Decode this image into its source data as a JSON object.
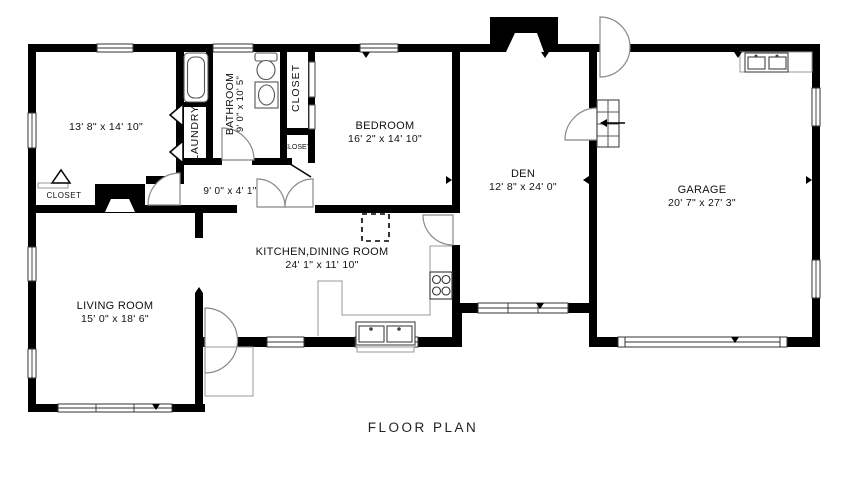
{
  "title": "FLOOR PLAN",
  "rooms": {
    "bedroom2": {
      "dims": "13' 8\" x 14' 10\""
    },
    "laundry": {
      "name": "LAUNDRY"
    },
    "bathroom": {
      "name": "BATHROOM",
      "dims": "9' 0\" x 10' 5\""
    },
    "hall_closet": {
      "name": "CLOSET"
    },
    "small_closet": {
      "name": "CLOSET"
    },
    "living_closet": {
      "name": "CLOSET"
    },
    "hallway": {
      "dims": "9' 0\" x 4' 1\""
    },
    "bedroom": {
      "name": "BEDROOM",
      "dims": "16' 2\" x 14' 10\""
    },
    "den": {
      "name": "DEN",
      "dims": "12' 8\" x 24' 0\""
    },
    "garage": {
      "name": "GARAGE",
      "dims": "20' 7\" x 27' 3\""
    },
    "kitchen_dining": {
      "name": "KITCHEN,DINING ROOM",
      "dims": "24' 1\" x 11' 10\""
    },
    "living_room": {
      "name": "LIVING ROOM",
      "dims": "15' 0\" x 18' 6\""
    }
  },
  "colors": {
    "wall": "#000000",
    "background": "#ffffff",
    "fixture_line": "#555555"
  }
}
